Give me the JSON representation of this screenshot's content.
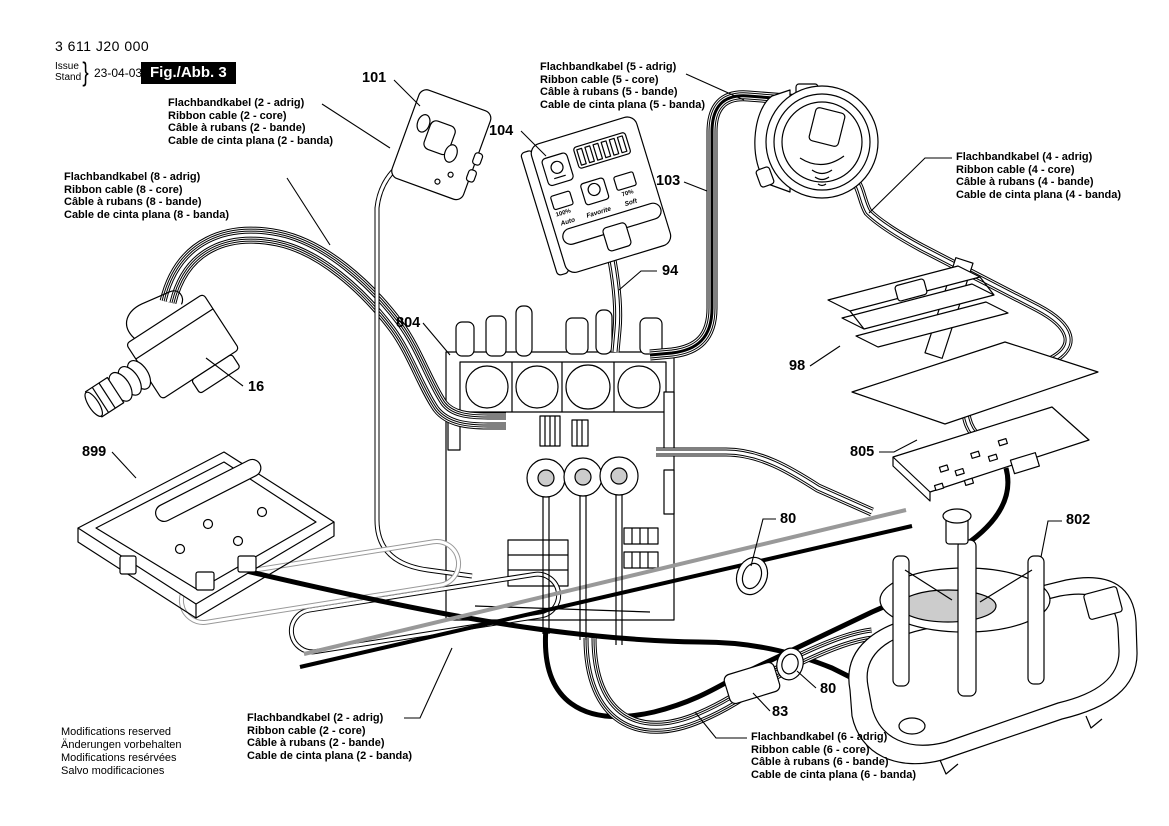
{
  "header": {
    "part_number": "3 611 J20 000",
    "issue_label": "Issue",
    "stand_label": "Stand",
    "brace": "}",
    "date": "23-04-03",
    "figure_label": "Fig./Abb. 3"
  },
  "cable_labels": {
    "two_core_top": {
      "lines": [
        "Flachbandkabel (2 - adrig)",
        "Ribbon cable (2 - core)",
        "Câble à rubans (2 - bande)",
        "Cable de cinta plana (2 - banda)"
      ]
    },
    "five_core": {
      "lines": [
        "Flachbandkabel (5 - adrig)",
        "Ribbon cable (5 - core)",
        "Câble à rubans (5 - bande)",
        "Cable de cinta plana (5 - banda)"
      ]
    },
    "eight_core": {
      "lines": [
        "Flachbandkabel (8 - adrig)",
        "Ribbon cable (8 - core)",
        "Câble à rubans (8 - bande)",
        "Cable de cinta plana (8 - banda)"
      ]
    },
    "four_core": {
      "lines": [
        "Flachbandkabel (4 - adrig)",
        "Ribbon cable (4 - core)",
        "Câble à rubans (4 - bande)",
        "Cable de cinta plana (4 - banda)"
      ]
    },
    "two_core_bottom": {
      "lines": [
        "Flachbandkabel (2 - adrig)",
        "Ribbon cable (2 - core)",
        "Câble à rubans (2 - bande)",
        "Cable de cinta plana (2 - banda)"
      ]
    },
    "six_core": {
      "lines": [
        "Flachbandkabel (6 - adrig)",
        "Ribbon cable (6 - core)",
        "Câble à rubans (6 - bande)",
        "Cable de cinta plana (6 - banda)"
      ]
    }
  },
  "parts": {
    "p16": "16",
    "p80": "80",
    "p83": "83",
    "p94": "94",
    "p98": "98",
    "p101": "101",
    "p103": "103",
    "p104": "104",
    "p802": "802",
    "p804": "804",
    "p805": "805",
    "p899": "899"
  },
  "panel": {
    "labels": [
      "Auto",
      "Favorite",
      "Soft"
    ],
    "values": [
      "100%",
      "70%"
    ]
  },
  "footer": {
    "lines": [
      "Modifications reserved",
      "Änderungen vorbehalten",
      "Modifications resérvées",
      "Salvo modificaciones"
    ]
  }
}
